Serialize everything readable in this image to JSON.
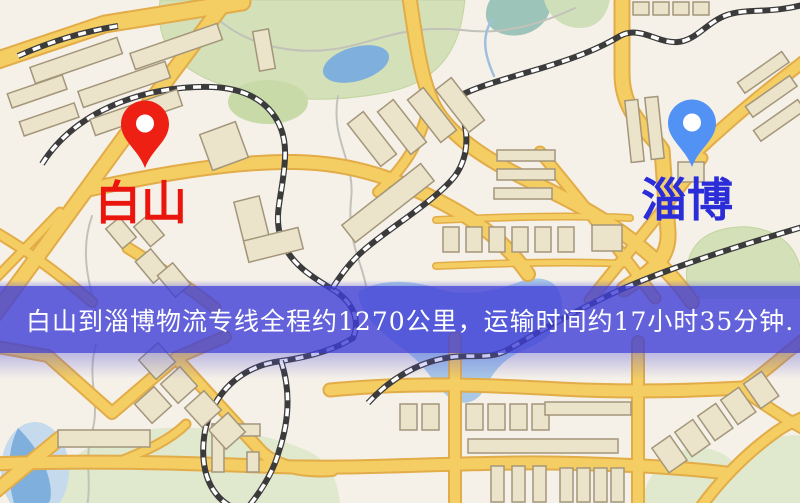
{
  "map": {
    "type": "stylized-street-map",
    "origin_marker": {
      "name": "白山",
      "pin_icon": "map-pin",
      "pin_color": "#ee2013",
      "label_color": "#ea150c"
    },
    "destination_marker": {
      "name": "淄博",
      "pin_icon": "map-pin",
      "pin_color": "#5392f5",
      "label_color": "#2b2dd8"
    },
    "banner": {
      "text": "白山到淄博物流专线全程约1270公里，运输时间约17小时35分钟.",
      "background_color": "rgba(62,62,215,0.80)",
      "text_color": "#ffffff",
      "route": {
        "origin": "白山",
        "destination": "淄博",
        "distance_km": 1270,
        "duration_hours": 17,
        "duration_minutes": 35
      }
    },
    "palette": {
      "background": "#f6f1e8",
      "park_green": "#d3e0b8",
      "pale_green": "#e0e8cd",
      "water_blue": "#7fafdc",
      "lake_blue": "#a9c8e6",
      "road_yellow": "#f4cd63",
      "road_casing": "#e2ac48",
      "railway_dark": "#3b3b3b",
      "building_fill": "#ebe3ca",
      "building_stroke": "#a3967a"
    }
  }
}
